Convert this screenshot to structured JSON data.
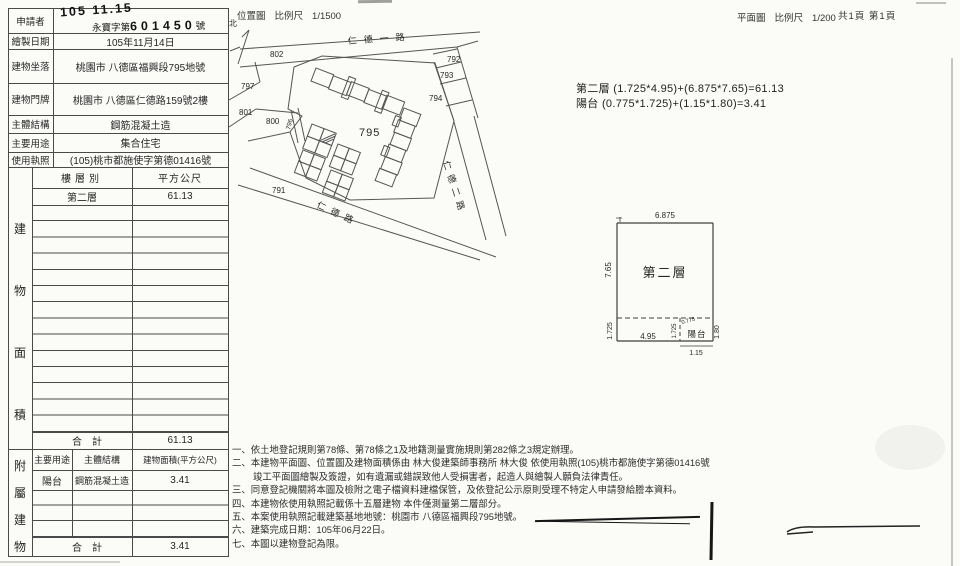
{
  "header": {
    "location_map": "位置圖",
    "scale": "比例尺",
    "location_scale_value": "1/1500",
    "plan": "平面圖",
    "plan_scale_value": "1/200",
    "page_info": "共1頁 第1頁",
    "north": "北"
  },
  "stamp": {
    "date": "105 11.15",
    "prefix": "永寶字第",
    "digits": "601450",
    "suffix": "號"
  },
  "info": {
    "applicant_label": "申請者",
    "rows": [
      {
        "label": "繪製日期",
        "value": "105年11月14日"
      },
      {
        "label": "建物坐落",
        "value": "桃園市 八德區福興段795地號"
      },
      {
        "label": "建物門牌",
        "value": "桃園市 八德區仁德路159號2樓"
      },
      {
        "label": "主體結構",
        "value": "鋼筋混凝土造"
      },
      {
        "label": "主要用途",
        "value": "集合住宅"
      },
      {
        "label": "使用執照",
        "value": "(105)桃市都施使字第德01416號"
      }
    ]
  },
  "area_table": {
    "side_label": "建物面積",
    "col_floor": "樓層別",
    "col_area": "平方公尺",
    "floor": "第二層",
    "area": "61.13",
    "total_label": "合計",
    "total": "61.13"
  },
  "annex_table": {
    "side_label": "附屬建物",
    "col_use": "主要用途",
    "col_structure": "主體結構",
    "col_area": "建物面積(平方公尺)",
    "use": "陽台",
    "structure": "鋼筋混凝土造",
    "area": "3.41",
    "total_label": "合計",
    "total": "3.41"
  },
  "formulas": {
    "floor2": "第二層 (1.725*4.95)+(6.875*7.65)=61.13",
    "balcony": "陽台 (0.775*1.725)+(1.15*1.80)=3.41"
  },
  "map": {
    "street_top": "仁德一路",
    "street_bottom": "仁德路",
    "street_right": "仁德二路",
    "parcels": {
      "p791": "791",
      "p792": "792",
      "p793": "793",
      "p794": "794",
      "p795": "795",
      "p796": "796",
      "p797": "797",
      "p800": "800",
      "p801": "801",
      "p802": "802"
    }
  },
  "plan": {
    "room": "第二層",
    "balcony": "陽台",
    "dim_top": "6.875",
    "dim_left": "7.65",
    "dim_bottom_left": "1.725",
    "dim_bottom": "4.95",
    "dim_balcony_h": "1.725",
    "dim_balcony_w": "0.775",
    "dim_right": "1.80",
    "dim_bottom_right": "1.15"
  },
  "notes": [
    "一、依土地登記規則第78條、第78條之1及地籍測量實施規則第282條之3規定辦理。",
    "二、本建物平面圖、位置圖及建物面積係由 林大俊建築師事務所 林大俊 依使用執照(105)桃市都施使字第德01416號",
    "竣工平面圖繪製及簽證，如有遺漏或錯誤致他人受損害者，起造人與繪製人願負法律責任。",
    "三、同意登記機關將本圖及檢附之電子檔資料建檔保管，及依登記公示原則受理不特定人申請發給謄本資料。",
    "四、本建物依使用執照記載係十五層建物 本件僅測量第二層部分。",
    "五、本案使用執照記載建築基地地號：桃園市 八德區福興段795地號。",
    "六、建築完成日期：105年06月22日。",
    "七、本圖以建物登記為限。"
  ]
}
